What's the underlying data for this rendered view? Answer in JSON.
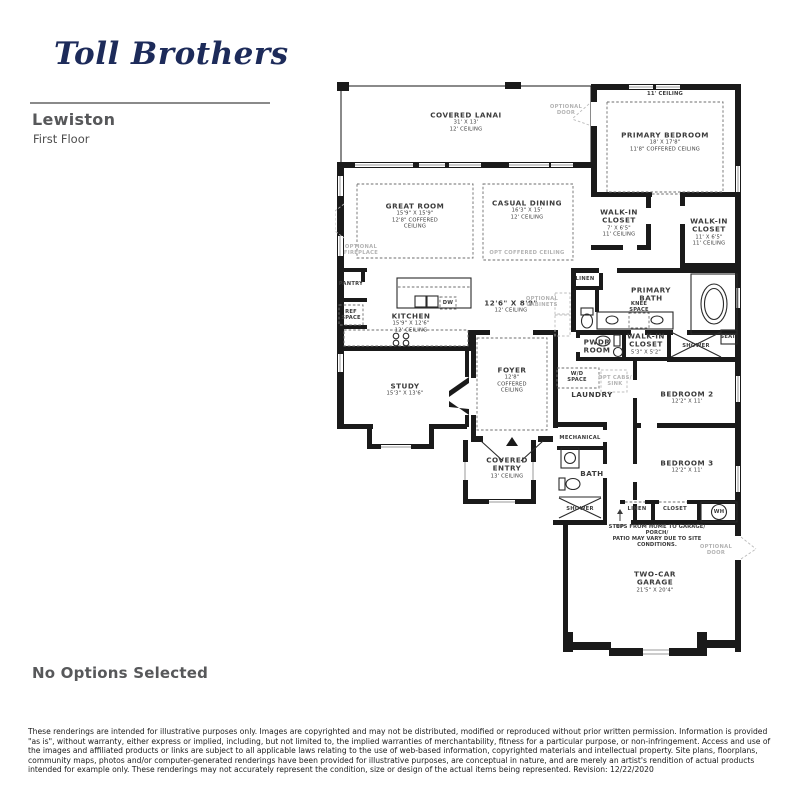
{
  "brand": {
    "logo_text": "Toll Brothers"
  },
  "plan": {
    "name": "Lewiston",
    "floor": "First Floor",
    "options_status": "No Options Selected",
    "labels": [
      {
        "name": "label-covered-lanai",
        "x": 131,
        "y": 42,
        "title": "COVERED LANAI",
        "sub": "31' X 13'\n12' CEILING"
      },
      {
        "name": "label-optional-door-lanai",
        "x": 231,
        "y": 30,
        "cls": "opt",
        "sub": "OPTIONAL\nDOOR"
      },
      {
        "name": "label-primary-bedroom-ceiling",
        "x": 330,
        "y": 14,
        "cls": "tiny",
        "sub": "11' CEILING"
      },
      {
        "name": "label-primary-bedroom",
        "x": 330,
        "y": 62,
        "title": "PRIMARY BEDROOM",
        "sub": "18' X 17'8\"\n11'8\" COFFERED CEILING"
      },
      {
        "name": "label-great-room",
        "x": 80,
        "y": 136,
        "title": "GREAT ROOM",
        "sub": "15'9\" X 15'9\"\n12'8\" COFFERED\nCEILING"
      },
      {
        "name": "label-casual-dining",
        "x": 192,
        "y": 130,
        "title": "CASUAL DINING",
        "sub": "16'3\" X 15'\n12' CEILING"
      },
      {
        "name": "label-opt-coffered-ceiling",
        "x": 192,
        "y": 173,
        "cls": "opt",
        "sub": "OPT COFFERED CEILING"
      },
      {
        "name": "label-optional-fireplace",
        "x": 26,
        "y": 170,
        "cls": "opt",
        "sub": "OPTIONAL\nFIREPLACE"
      },
      {
        "name": "label-walk-in-closet-1",
        "x": 284,
        "y": 143,
        "title": "WALK-IN\nCLOSET",
        "sub": "7' X 6'5\"\n11' CEILING"
      },
      {
        "name": "label-walk-in-closet-2",
        "x": 374,
        "y": 152,
        "title": "WALK-IN\nCLOSET",
        "sub": "11' X 6'5\"\n11' CEILING"
      },
      {
        "name": "label-pantry",
        "x": 16,
        "y": 204,
        "cls": "small",
        "sub": "PANTRY"
      },
      {
        "name": "label-ref-space",
        "x": 16,
        "y": 235,
        "cls": "tiny",
        "sub": "REF\nSPACE"
      },
      {
        "name": "label-dw",
        "x": 113,
        "y": 223,
        "cls": "tiny",
        "sub": "DW"
      },
      {
        "name": "label-kitchen",
        "x": 76,
        "y": 243,
        "title": "KITCHEN",
        "sub": "15'9\" X 12'6\"\n12' CEILING"
      },
      {
        "name": "label-hall",
        "x": 176,
        "y": 227,
        "title": "12'6\" X 8'9\"",
        "sub": "12' CEILING"
      },
      {
        "name": "label-optional-cabinets",
        "x": 207,
        "y": 222,
        "cls": "opt",
        "sub": "OPTIONAL\nCABINETS"
      },
      {
        "name": "label-linen-primary",
        "x": 250,
        "y": 199,
        "cls": "small",
        "sub": "LINEN"
      },
      {
        "name": "label-primary-bath",
        "x": 316,
        "y": 215,
        "title": "PRIMARY\nBATH"
      },
      {
        "name": "label-knee-space",
        "x": 304,
        "y": 227,
        "cls": "tiny",
        "sub": "KNEE\nSPACE"
      },
      {
        "name": "label-pwdr-room",
        "x": 262,
        "y": 267,
        "title": "PWDR\nROOM"
      },
      {
        "name": "label-walk-in-closet-3",
        "x": 311,
        "y": 264,
        "title": "WALK-IN\nCLOSET",
        "sub": "5'3\" X 5'2\""
      },
      {
        "name": "label-shower-primary",
        "x": 361,
        "y": 266,
        "cls": "small",
        "sub": "SHOWER"
      },
      {
        "name": "label-seat",
        "x": 393,
        "y": 257,
        "cls": "tiny",
        "sub": "SEAT"
      },
      {
        "name": "label-wd-space",
        "x": 242,
        "y": 297,
        "cls": "tiny",
        "sub": "W/D\nSPACE"
      },
      {
        "name": "label-opt-cabs-sink",
        "x": 280,
        "y": 301,
        "cls": "opt",
        "sub": "OPT CABS/\nSINK"
      },
      {
        "name": "label-laundry",
        "x": 257,
        "y": 315,
        "title": "LAUNDRY"
      },
      {
        "name": "label-bedroom-2",
        "x": 352,
        "y": 318,
        "title": "BEDROOM 2",
        "sub": "12'2\" X 11'"
      },
      {
        "name": "label-study",
        "x": 70,
        "y": 310,
        "title": "STUDY",
        "sub": "15'3\" X 13'6\""
      },
      {
        "name": "label-foyer",
        "x": 177,
        "y": 300,
        "title": "FOYER",
        "sub": "12'8\"\nCOFFERED\nCEILING"
      },
      {
        "name": "label-mechanical",
        "x": 245,
        "y": 358,
        "cls": "small",
        "sub": "MECHANICAL"
      },
      {
        "name": "label-covered-entry",
        "x": 172,
        "y": 388,
        "title": "COVERED\nENTRY",
        "sub": "13' CEILING"
      },
      {
        "name": "label-bath",
        "x": 257,
        "y": 394,
        "title": "BATH"
      },
      {
        "name": "label-shower-bath",
        "x": 245,
        "y": 429,
        "cls": "small",
        "sub": "SHOWER"
      },
      {
        "name": "label-bedroom-3",
        "x": 352,
        "y": 387,
        "title": "BEDROOM 3",
        "sub": "12'2\" X 11'"
      },
      {
        "name": "label-linen-hall",
        "x": 302,
        "y": 429,
        "cls": "small",
        "sub": "LINEN"
      },
      {
        "name": "label-closet",
        "x": 340,
        "y": 429,
        "cls": "small",
        "sub": "CLOSET"
      },
      {
        "name": "label-wh",
        "x": 384,
        "y": 432,
        "cls": "tiny",
        "sub": "WH"
      },
      {
        "name": "label-up",
        "x": 285,
        "y": 447,
        "cls": "tiny",
        "sub": "UP"
      },
      {
        "name": "label-steps-note",
        "x": 322,
        "y": 456,
        "cls": "note",
        "sub": "STEPS FROM HOME TO GARAGE/ PORCH/\nPATIO MAY VARY DUE TO SITE CONDITIONS."
      },
      {
        "name": "label-optional-door-garage",
        "x": 381,
        "y": 470,
        "cls": "opt",
        "sub": "OPTIONAL\nDOOR"
      },
      {
        "name": "label-garage",
        "x": 320,
        "y": 502,
        "title": "TWO-CAR\nGARAGE",
        "sub": "21'5\" X 20'4\""
      }
    ]
  },
  "colors": {
    "brand_navy": "#1d2b5a",
    "heading_gray": "#57585a",
    "wall_black": "#1a1a1a",
    "optional_gray": "#b3b3b3"
  },
  "disclaimer": "These renderings are intended for illustrative purposes only. Images are copyrighted and may not be distributed, modified or reproduced without prior written permission. Information is provided \"as is\", without warranty, either express or implied, including, but not limited to, the implied warranties of merchantability, fitness for a particular purpose, or non-infringement. Access and use of the images and affiliated products or links are subject to all applicable laws relating to the use of web-based information, copyrighted materials and intellectual property. Site plans, floorplans, community maps, photos and/or computer-generated renderings have been provided for illustrative purposes, are conceptual in nature, and are merely an artist's rendition of actual products intended for example only. These renderings may not accurately represent the condition, size or design of the actual items being represented. Revision: 12/22/2020"
}
